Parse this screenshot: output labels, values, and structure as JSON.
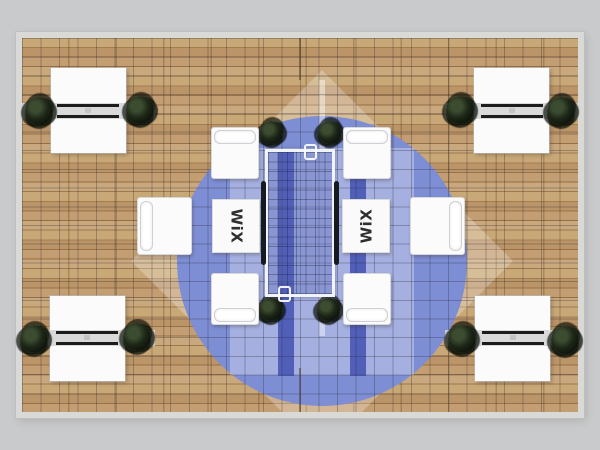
{
  "scene": {
    "description": "Top-down render of a rectangular trade-show booth: wood plank floor, central round blue rug, glass conference table with black side rails, eight white seats, four corner storage counters flanked by plants",
    "background_color": "#c9cacb"
  },
  "branding": {
    "left_seat_label": "WiX",
    "right_seat_label": "WiX"
  },
  "palette": {
    "platform_rim": "#d9d9d8",
    "wood_base": "#b58e62",
    "carpet_blue": "#7e8ed5",
    "carpet_blue_light": "#a9b4e6",
    "carpet_runner_dark": "#4a58b4",
    "furniture_white": "#fbfbfc",
    "cabinet_band_gray": "#d4d4d4",
    "handle_black": "#1c1c1c",
    "plant_green": "#1d2617",
    "table_rail_black": "#171a21"
  },
  "inventory": {
    "storage_cabinets": 4,
    "cabinet_plants": 8,
    "table_corner_plants": 4,
    "corner_armchairs": 4,
    "side_armchairs": 2,
    "branded_seats": 2,
    "glass_tables": 1,
    "round_rugs": 1
  }
}
